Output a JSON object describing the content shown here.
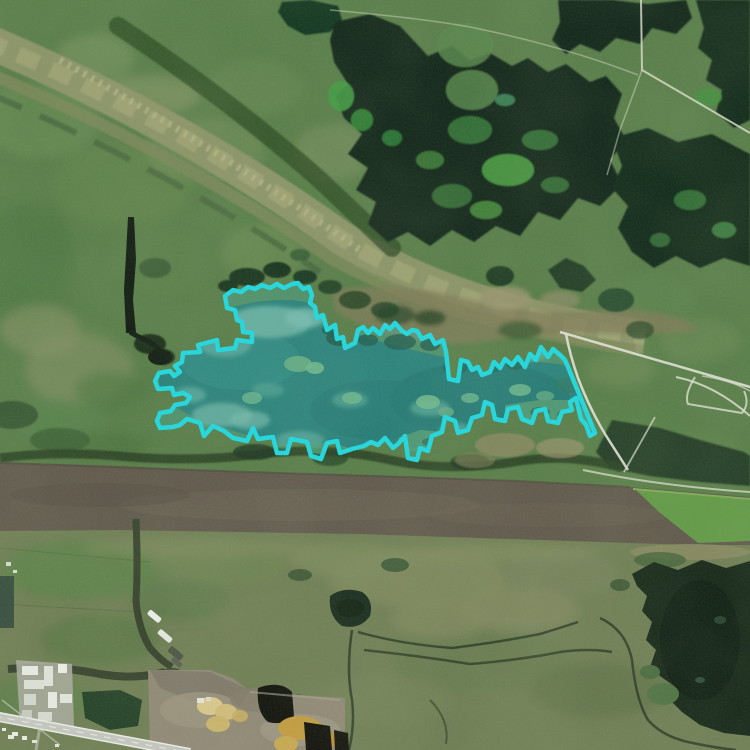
{
  "map": {
    "title": "Satellite aerial view with highlighted wetland lake region",
    "view_type": "satellite-imagery",
    "overlay": {
      "label": "selected-region",
      "stroke_color": "#29d6dc",
      "fill_color": "#36d6de",
      "fill_opacity": "0.22",
      "stroke_width": "4.5",
      "polygon_points": "225,296 233,290 241,292 248,287 255,289 262,285 270,288 277,284 284,288 292,284 298,283 303,289 309,287 312,295 310,303 315,307 317,318 323,315 327,330 335,325 337,339 343,337 345,348 355,343 358,330 363,327 368,333 373,328 380,334 385,325 390,329 395,323 402,331 407,334 412,330 417,331 422,339 430,335 435,344 443,340 446,352 449,379 458,381 461,360 468,362 472,370 478,367 482,375 490,372 494,362 500,368 505,359 512,365 518,357 525,367 530,354 536,360 541,347 548,357 553,349 560,355 565,360 568,367 577,389 586,411 595,433 590,436 586,425 581,419 576,398 570,402 572,410 562,412 558,423 548,421 545,409 536,411 532,423 522,419 518,407 508,409 505,421 495,419 492,405 485,402 482,415 472,418 468,430 458,433 455,421 445,417 442,432 432,436 428,451 420,448 417,460 408,458 405,436 398,444 393,448 385,438 378,445 371,442 364,446 352,449 340,453 337,441 327,443 321,459 311,456 307,442 291,439 287,453 277,453 273,437 258,439 253,428 247,441 233,438 224,431 213,426 204,436 200,423 187,419 180,425 173,427 160,428 157,421 160,413 171,411 175,405 186,403 190,397 183,393 174,395 172,388 158,389 155,381 159,373 170,371 174,376 180,372 175,366 182,362 183,353 200,352 198,345 217,340 218,350 235,348 237,340 252,342 252,333 243,332 242,322 237,320 235,310 227,308"
    },
    "features": {
      "lake": {
        "label": "lake-water",
        "color": "#26695e",
        "path": "M168,352 Q180,330 205,318 Q240,300 285,300 Q315,300 330,315 Q345,330 368,338 Q410,350 448,358 Q470,363 492,362 Q530,360 558,364 Q580,368 588,390 Q592,408 585,420 Q560,430 530,426 Q500,423 470,436 Q440,448 405,448 Q370,447 340,448 Q300,450 265,440 Q220,428 190,415 Q165,403 160,388 Q156,368 168,352 Z"
      },
      "river": {
        "label": "river",
        "color": "#5e564a",
        "path": "M0,462 L120,466 L250,472 L400,476 L520,481 L630,487 L750,497 L750,545 L690,545 L600,542 L480,538 L360,534 L240,532 L120,530 L0,531 Z"
      },
      "river_algae": {
        "label": "algae-bloom",
        "color": "#5f9e43"
      },
      "forest": {
        "label": "forest",
        "color": "#0d2416"
      },
      "marsh": {
        "label": "marsh",
        "color": "#567c47"
      },
      "dark_lake": {
        "label": "oxbow-lake",
        "color": "#132416",
        "path": "M632,574 L654,562 L678,570 L702,560 L726,568 L750,561 L750,736 L724,733 L700,725 L682,712 L670,700 L674,686 L660,676 L650,667 L656,650 L646,640 L652,622 L642,611 L647,596 L637,586 Z"
      },
      "highway": {
        "label": "highway",
        "color": "#c6c8c2",
        "path": "M-6,716 L190,753"
      },
      "canal": {
        "label": "canal",
        "color": "#333f2a"
      },
      "industrial": {
        "label": "industrial-site",
        "ground_color": "#8f8775"
      }
    }
  }
}
